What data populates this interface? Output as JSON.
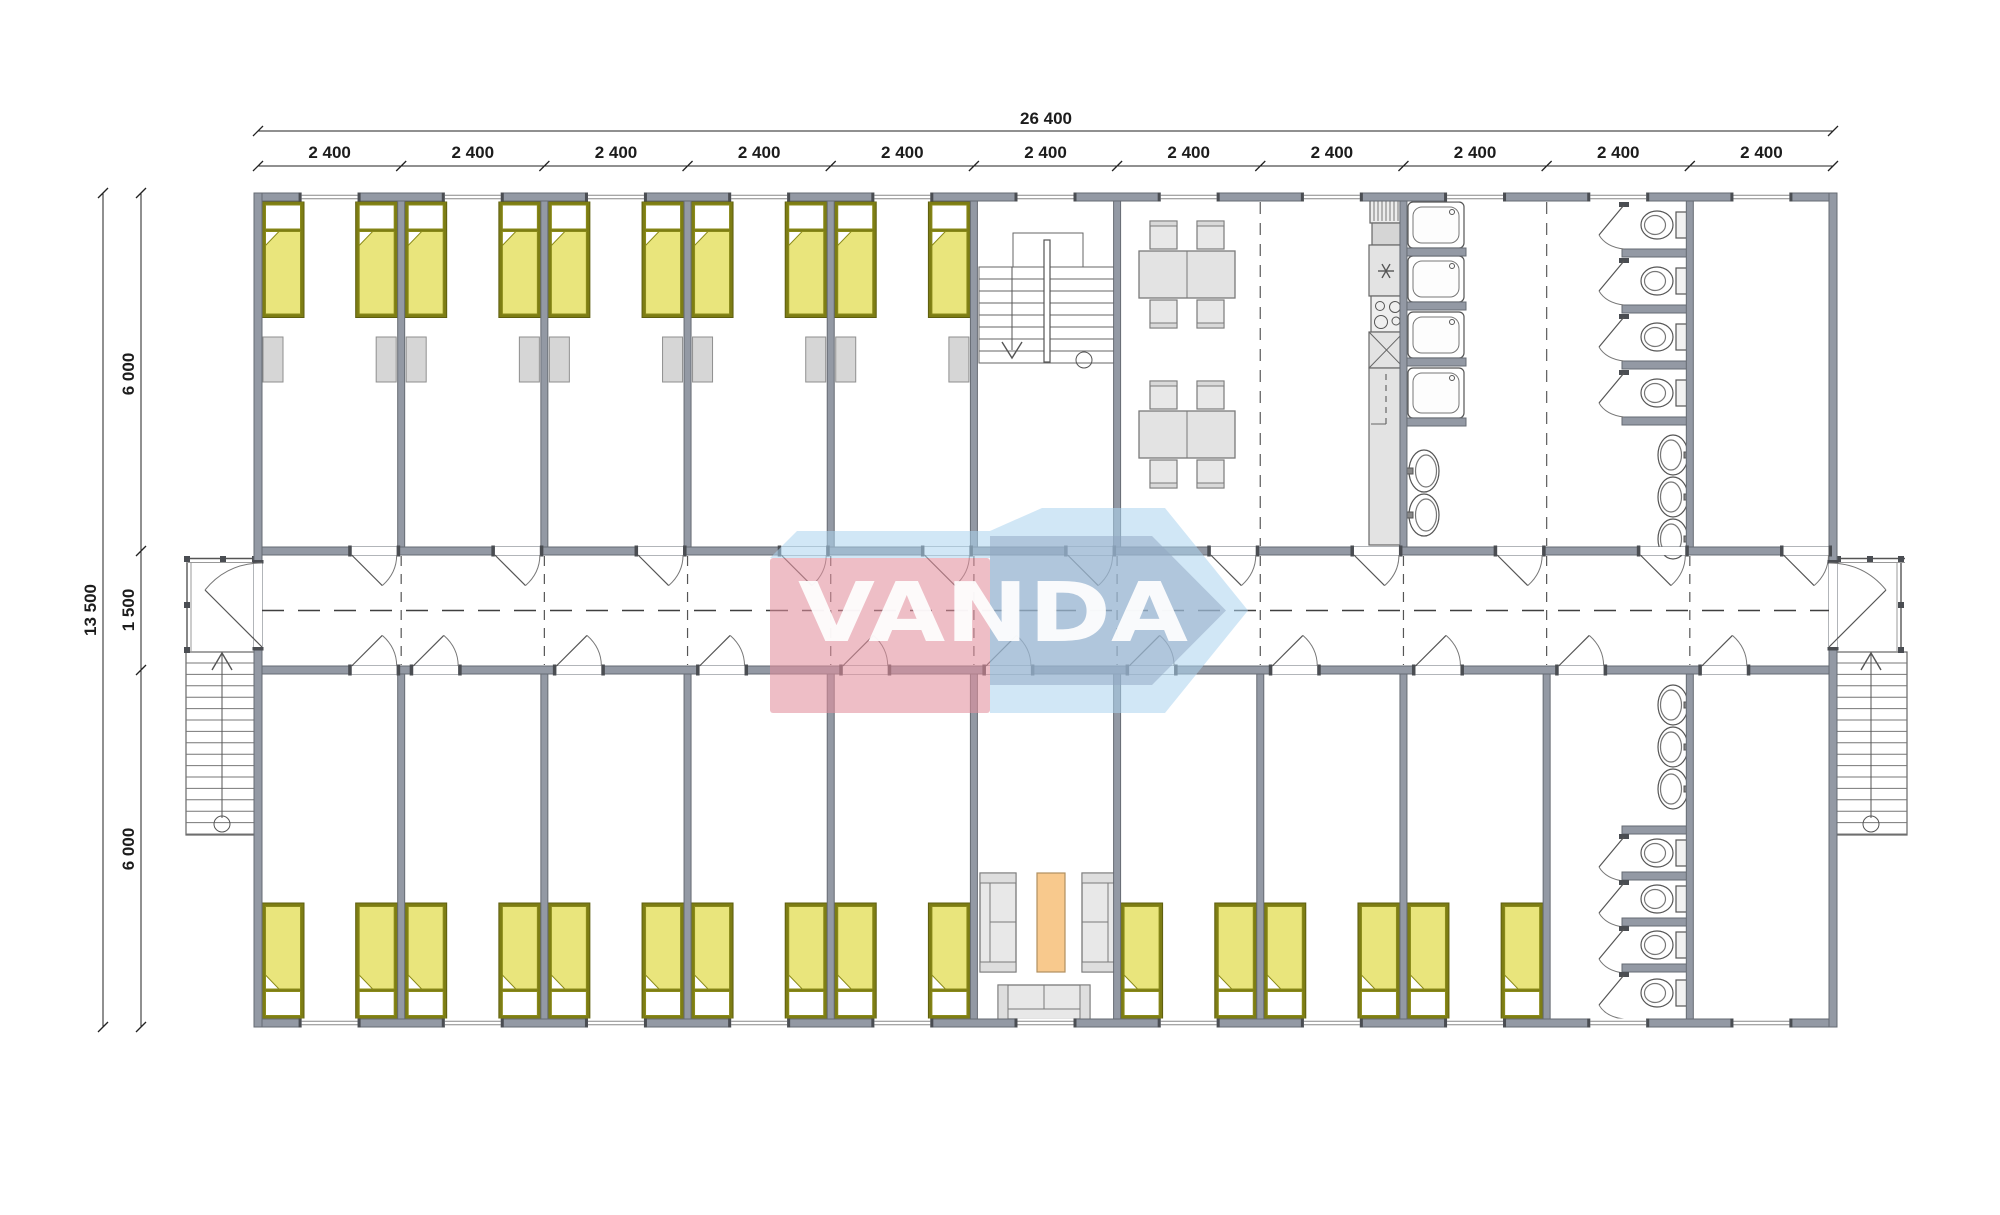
{
  "floor_plan": {
    "watermark": {
      "text": "VANDA",
      "pink": "#e28f9d",
      "light_blue": "#abd4ee",
      "steel_blue": "#8fa6c2",
      "text_color": "#ffffff"
    },
    "dimensions": {
      "overall_width": "26 400",
      "overall_height": "13 500",
      "bay_width": "2 400",
      "bay_count": 11,
      "rows": [
        "6 000",
        "1 500",
        "6 000"
      ]
    },
    "rooms": {
      "top": [
        "bedrooms (5 bays, 2 beds each)",
        "stairwell",
        "dining room",
        "kitchen",
        "shower room",
        "wc room",
        "storage room"
      ],
      "bottom": [
        "bedrooms (5 bays, 2 beds each)",
        "lounge",
        "bedrooms (3 bays, 2 beds each)",
        "wc room",
        "storage room"
      ],
      "corridor": "central corridor"
    },
    "fixtures": {
      "beds_top": 10,
      "beds_bottom": 16,
      "wardrobes": 10,
      "dining_sets": 2,
      "showers": 4,
      "wc_top": 4,
      "wc_bottom": 4,
      "basins_shower_room": 2,
      "basins_wc_top": 3,
      "basins_wc_bottom": 3,
      "sofas": 3,
      "coffee_table": 1,
      "exterior_stairs": 2
    },
    "colors": {
      "wall": "#9399a4",
      "wall_edge": "#666b73",
      "bed_frame": "#7d7d14",
      "bed_fill": "#e9e57c",
      "furniture_fill": "#e8e8e8",
      "furniture_edge": "#7a7a7a",
      "wardrobe": "#d6d6d6",
      "coffee_table": "#f8c98d",
      "line": "#555555"
    }
  }
}
